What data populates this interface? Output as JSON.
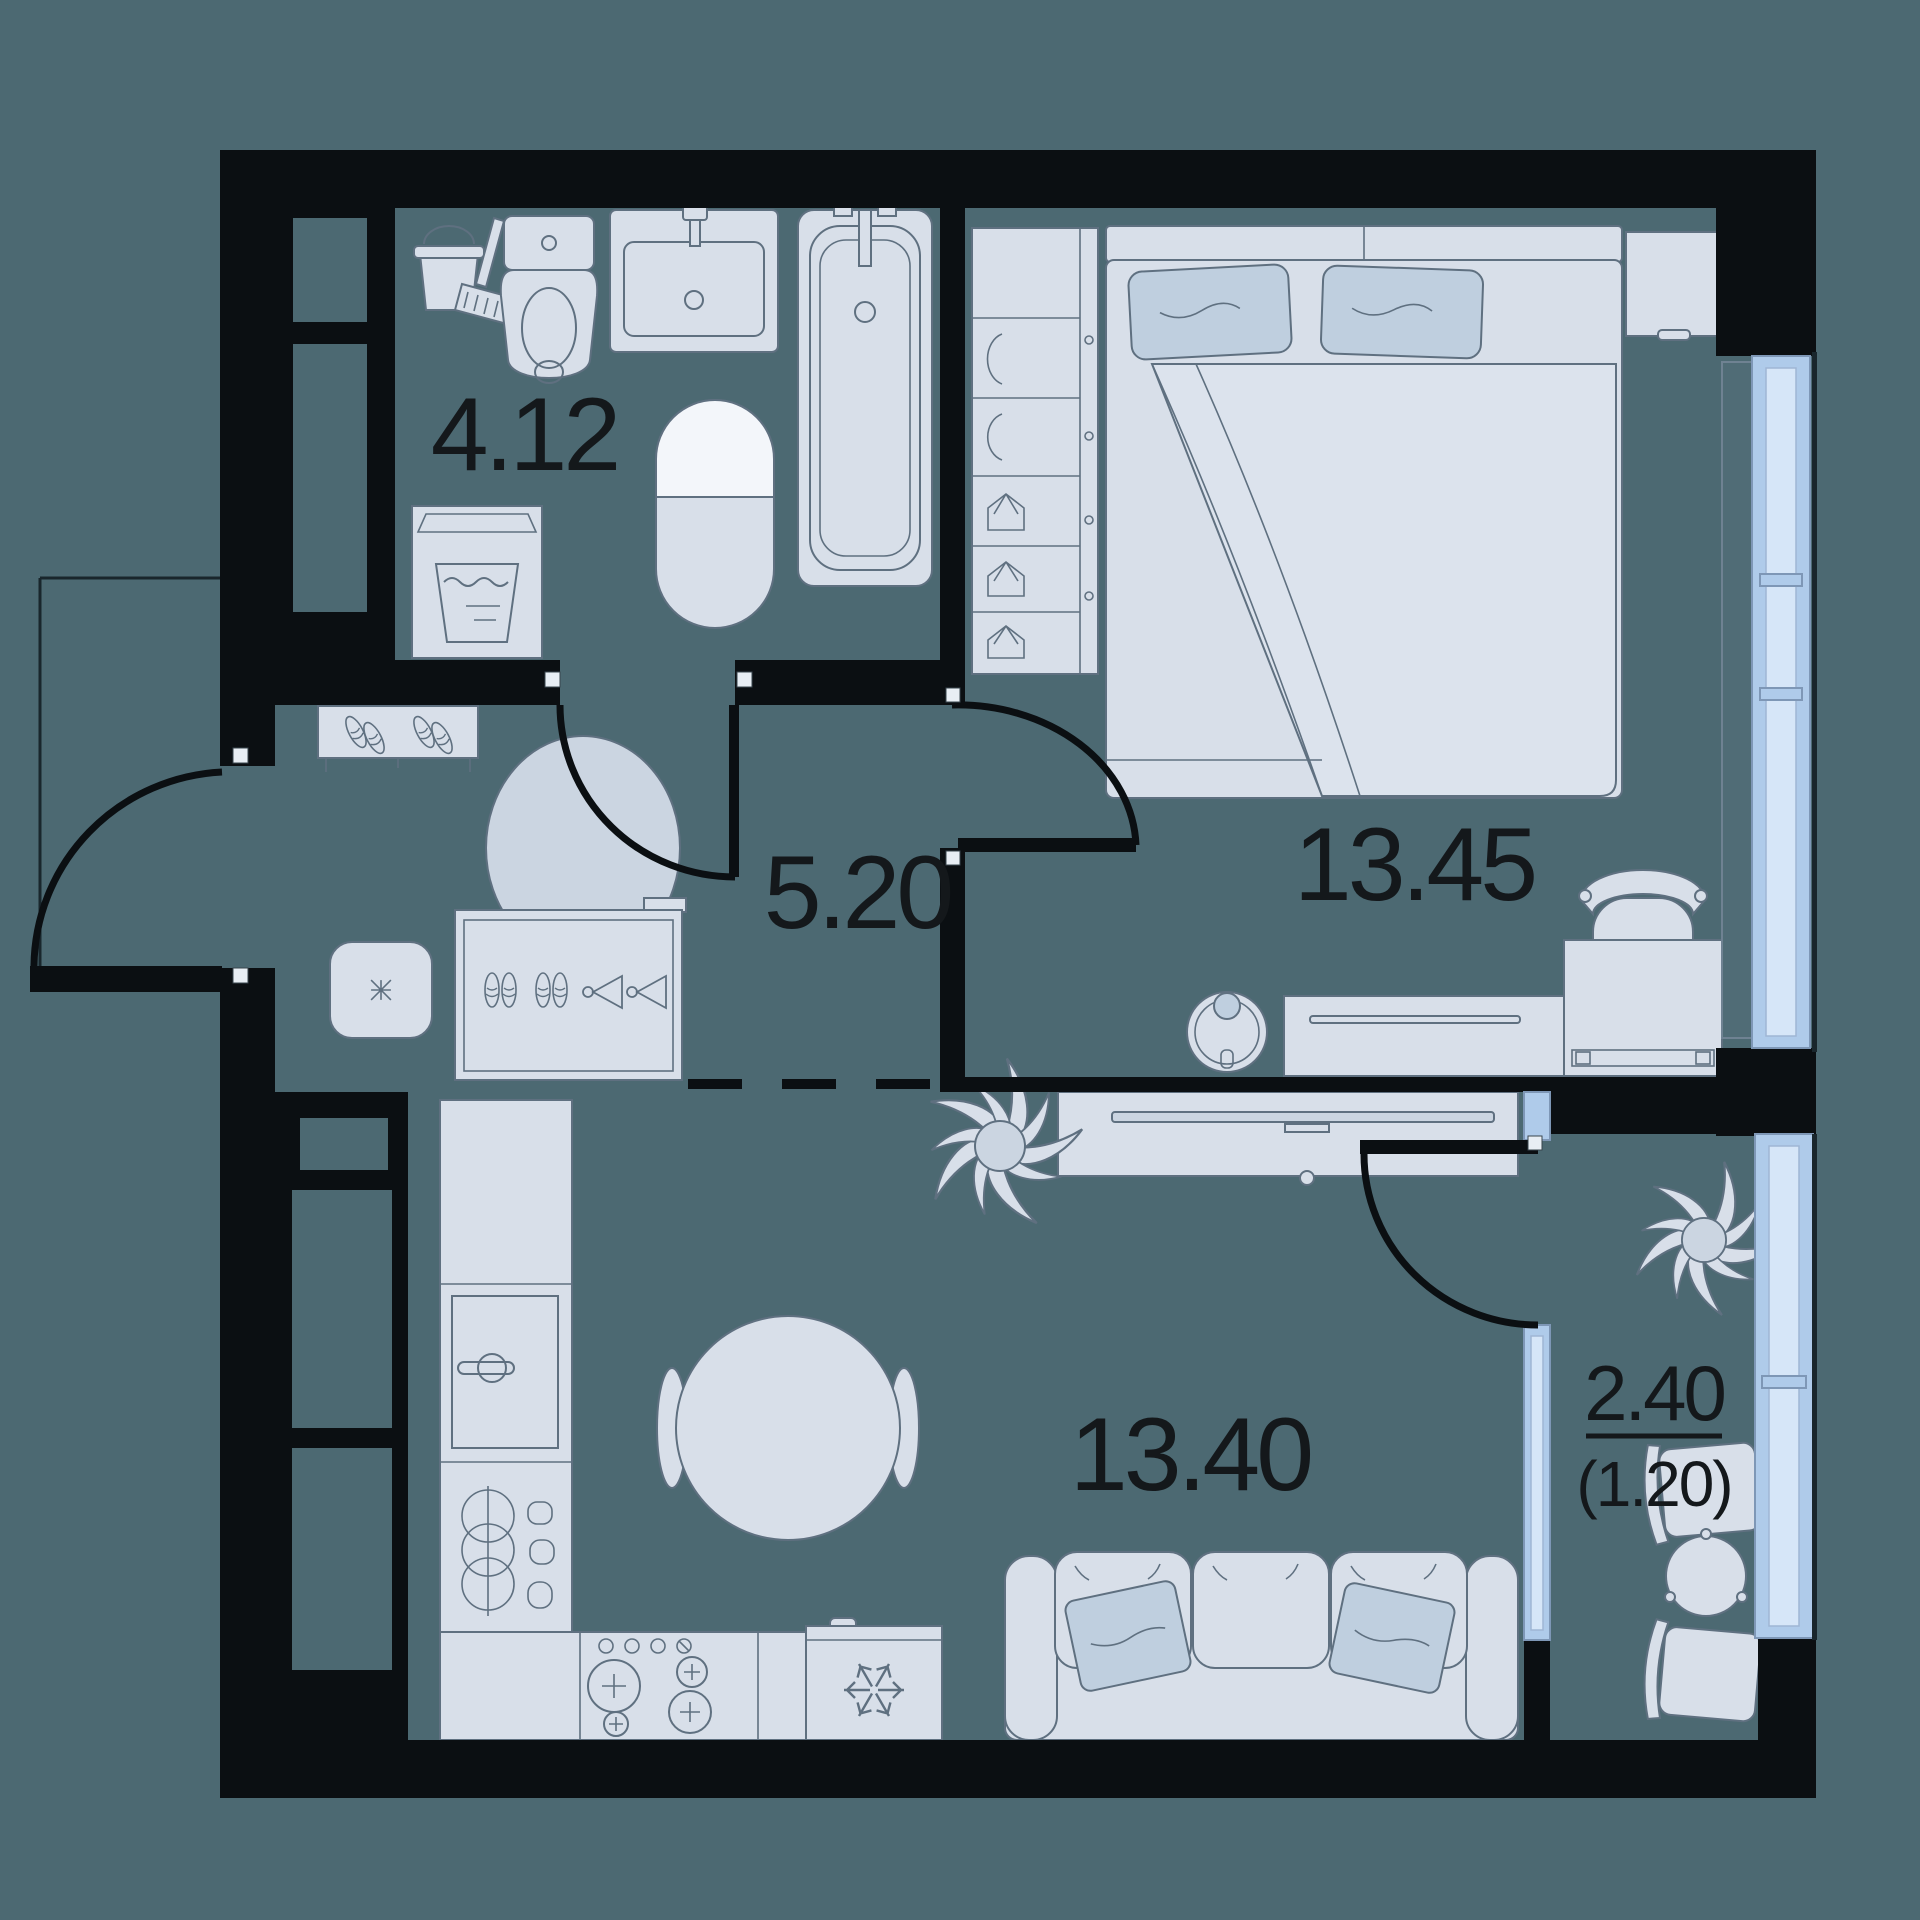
{
  "plan": {
    "type": "apartment-floor-plan",
    "rooms": [
      {
        "name": "bathroom",
        "area_label": "4.12"
      },
      {
        "name": "hallway",
        "area_label": "5.20"
      },
      {
        "name": "bedroom",
        "area_label": "13.45"
      },
      {
        "name": "kitchen-living-room",
        "area_label": "13.40"
      },
      {
        "name": "balcony",
        "area_label": "2.40",
        "area_label_secondary": "(1.20)"
      }
    ],
    "furniture": {
      "bathroom": [
        "cleaning-bucket-icon",
        "toilet-icon",
        "sink-icon",
        "water-heater-icon",
        "bathtub-icon",
        "washing-machine-icon"
      ],
      "hallway": [
        "shoe-rack-icon",
        "rug-icon",
        "pouf-icon",
        "wardrobe-icon"
      ],
      "bedroom": [
        "closet-icon",
        "bed-icon",
        "nightstand-icon",
        "dresser-icon",
        "desk-icon",
        "desk-chair-icon",
        "robot-vacuum-icon"
      ],
      "kitchen_living": [
        "kitchen-counter",
        "dishwasher-icon",
        "dishes-cabinet-icon",
        "stove-icon",
        "fridge-icon",
        "dining-table-icon",
        "dining-chair-icon",
        "plant-icon",
        "tv-stand-icon",
        "tv-icon",
        "sofa-icon"
      ],
      "balcony": [
        "plant-icon",
        "balcony-chair-icon",
        "balcony-table-icon"
      ]
    },
    "colors": {
      "background": "#4C6972",
      "walls": "#0B0F12",
      "furniture": "#D8DFE9",
      "accent": "#BFCFDF",
      "window_frame": "#AFCBEA",
      "window_glass": "#D6E6F8",
      "label": "#14181B"
    }
  }
}
